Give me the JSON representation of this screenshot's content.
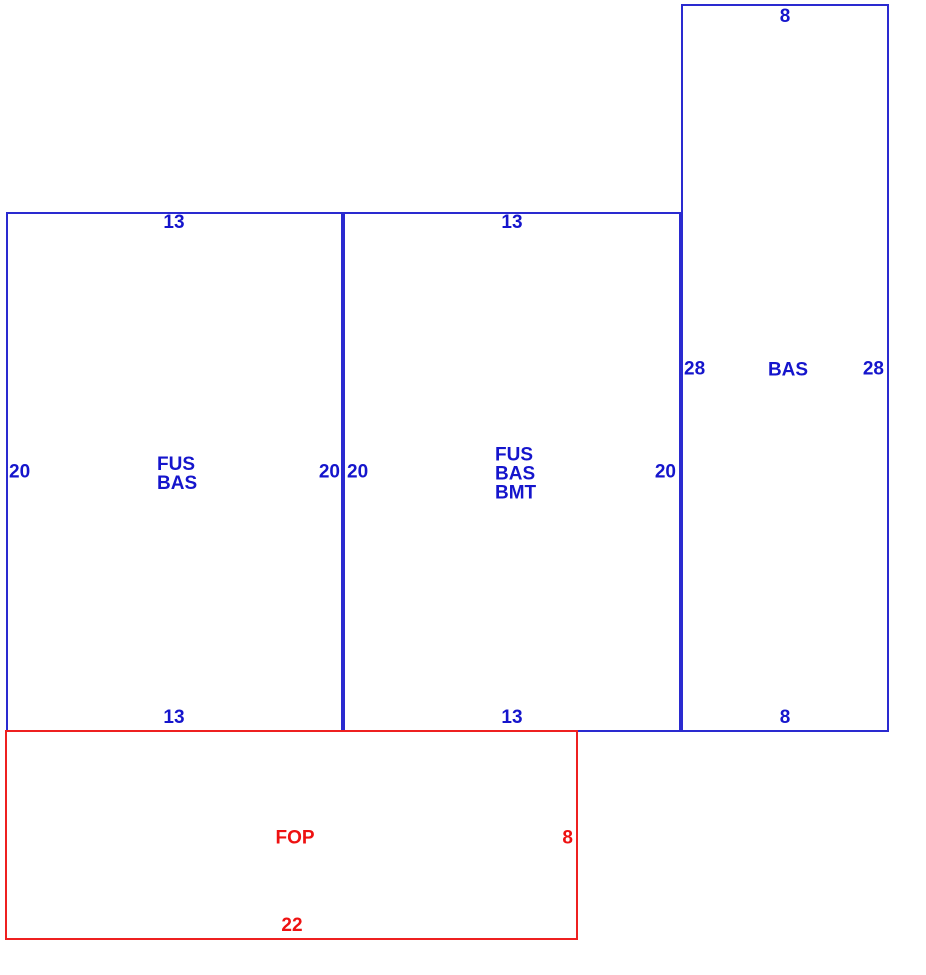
{
  "canvas": {
    "background": "#ffffff"
  },
  "colors": {
    "blue": "#1515cc",
    "red": "#ee1111"
  },
  "areas": [
    {
      "code": "FUS BAS",
      "label_lines": [
        "FUS",
        "BAS"
      ],
      "color": "blue",
      "dims": {
        "top": "13",
        "bottom": "13",
        "left": "20",
        "right": "20"
      }
    },
    {
      "code": "FUS BAS BMT",
      "label_lines": [
        "FUS",
        "BAS",
        "BMT"
      ],
      "color": "blue",
      "dims": {
        "top": "13",
        "bottom": "13",
        "left": "20",
        "right": "20"
      }
    },
    {
      "code": "BAS",
      "label_lines": [
        "BAS"
      ],
      "color": "blue",
      "dims": {
        "top": "8",
        "bottom": "8",
        "left": "28",
        "right": "28"
      }
    },
    {
      "code": "FOP",
      "label_lines": [
        "FOP"
      ],
      "color": "red",
      "dims": {
        "right": "8",
        "bottom": "22"
      }
    }
  ]
}
